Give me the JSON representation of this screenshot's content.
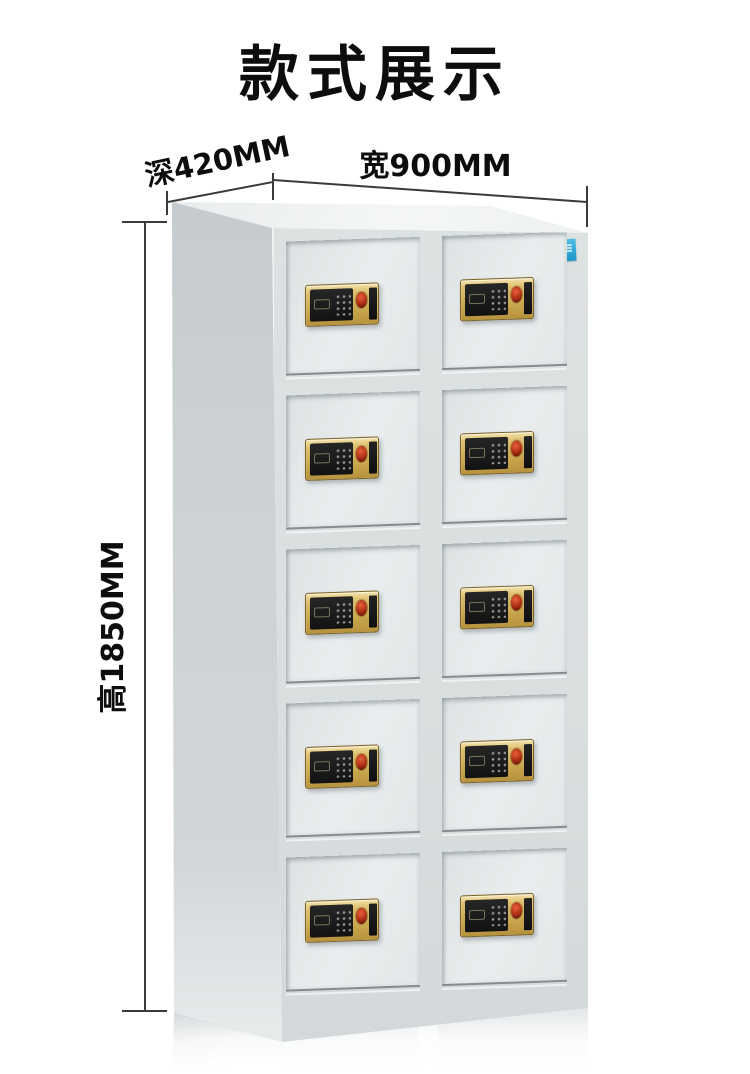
{
  "title": "款式展示",
  "dimensions": {
    "depth_label": "深420MM",
    "width_label": "宽900MM",
    "height_label": "高1850MM"
  },
  "cabinet": {
    "rows": 5,
    "columns": 2,
    "door_count": 10,
    "lock": {
      "type": "electronic-keypad-fingerprint-lock",
      "parts": [
        "display-window",
        "keypad-dots",
        "fingerprint-reader",
        "cover-panel"
      ]
    },
    "sticker": {
      "present": true,
      "text_legible": false
    }
  },
  "colors": {
    "background": "#ffffff",
    "text": "#0d0d0d",
    "dimension_line": "#3a3a3a",
    "cabinet_side": "#ccd1d3",
    "cabinet_frame": "#d9dedf",
    "door_panel": "#e9edee",
    "lock_gold": "#caa94f",
    "lock_panel": "#121212",
    "fingerprint": "#a92d14",
    "sticker": "#2fa9d9"
  }
}
